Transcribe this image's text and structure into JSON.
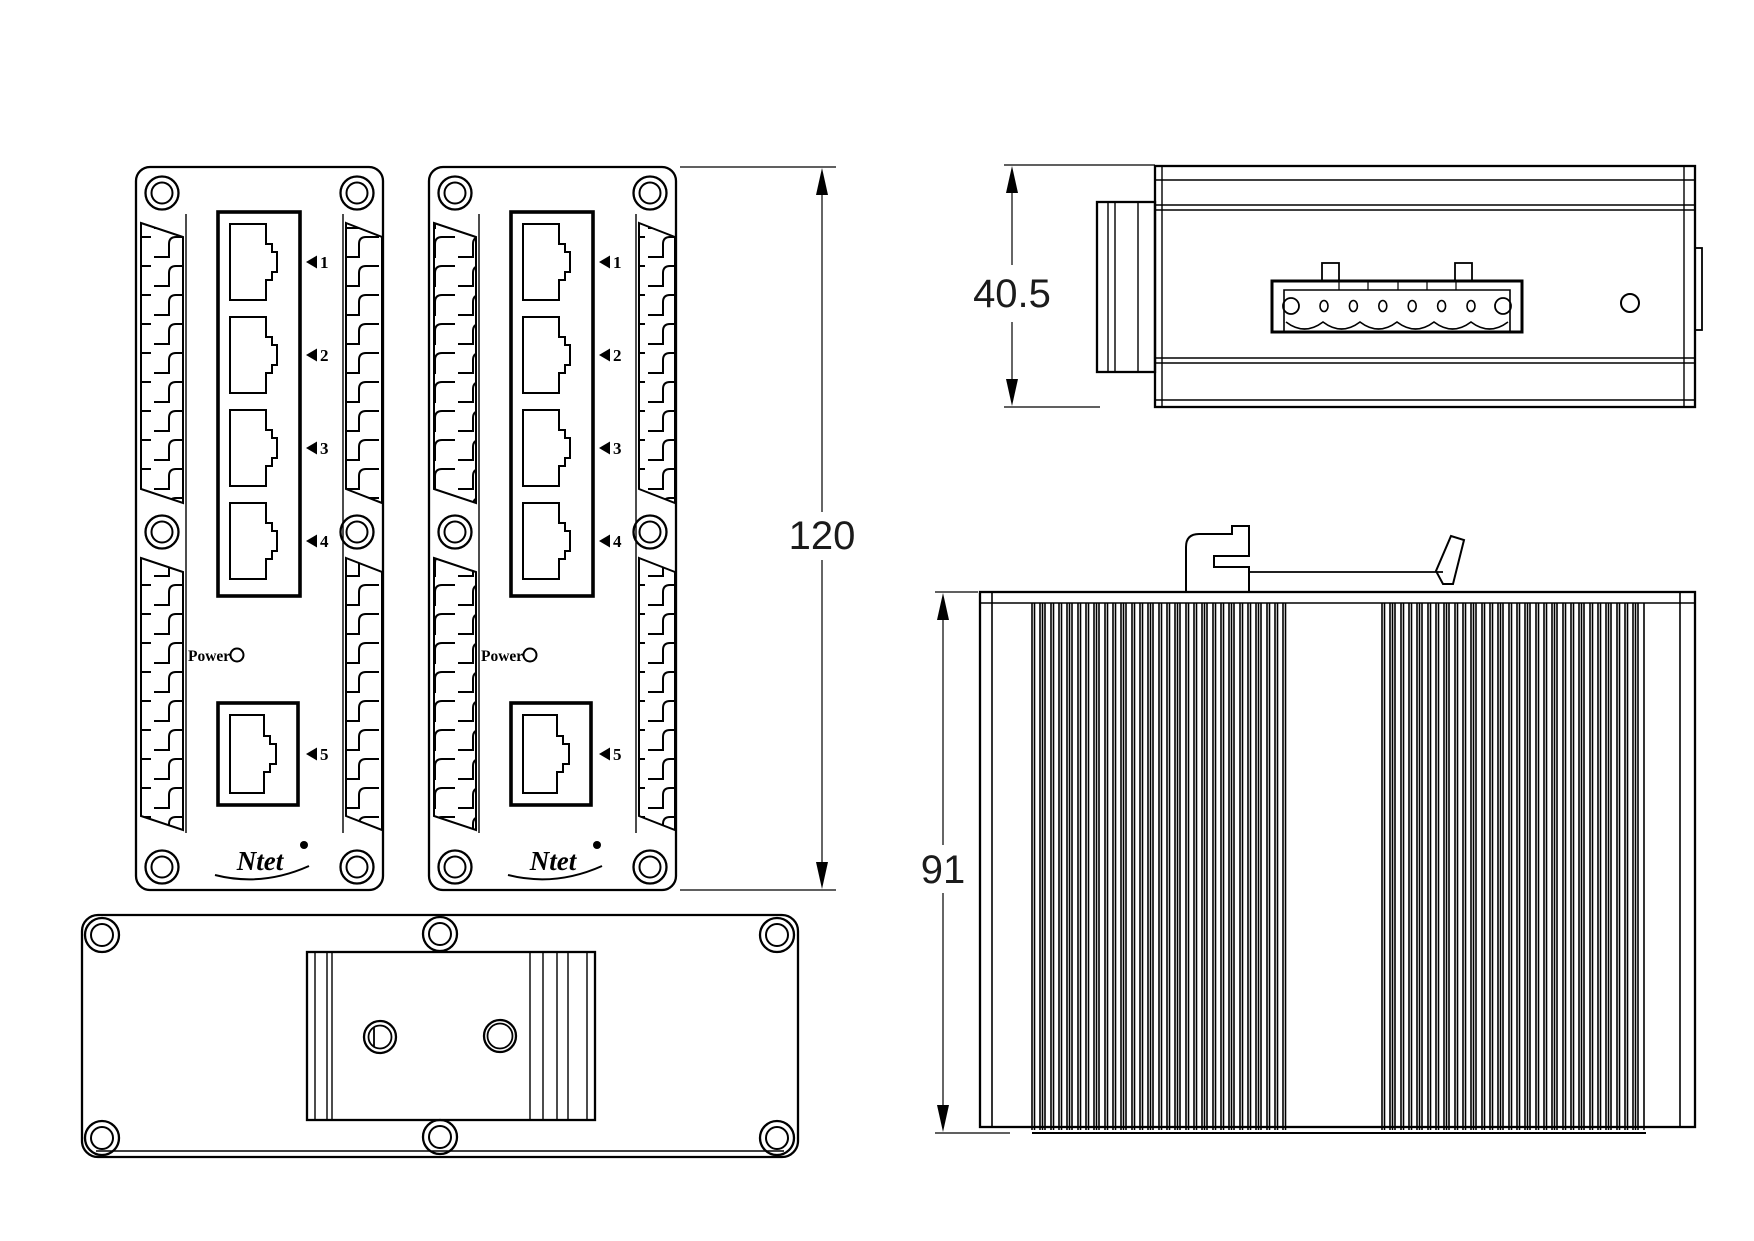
{
  "views": {
    "front": {
      "port_labels": [
        "1",
        "2",
        "3",
        "4",
        "5"
      ],
      "power_label": "Power",
      "logo_text": "Ntet"
    },
    "dimensions": {
      "overall_height": "120",
      "body_depth": "40.5",
      "heatsink_height": "91"
    }
  },
  "colors": {
    "line": "#000000",
    "background": "#ffffff"
  }
}
